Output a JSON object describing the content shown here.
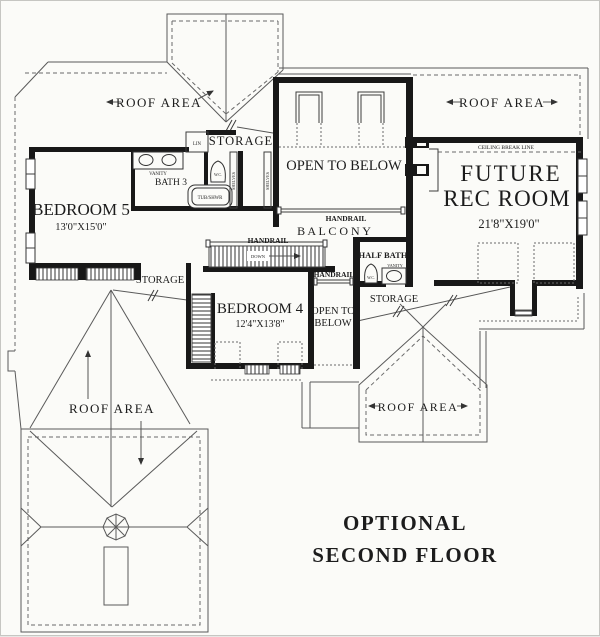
{
  "colors": {
    "background": "#fbfbf8",
    "line": "#1c1c1c",
    "roof_line": "#5a5a5a"
  },
  "title": {
    "line1": "OPTIONAL",
    "line2": "SECOND FLOOR"
  },
  "labels": {
    "roof_area": "ROOF AREA",
    "storage": "STORAGE",
    "open_to_below": "OPEN TO BELOW",
    "open_to": "OPEN TO",
    "below": "BELOW",
    "balcony": "B A L C O N Y",
    "handrail": "HANDRAIL",
    "ceiling_break_line": "CEILING BREAK LINE",
    "down": "DOWN",
    "lin": "LIN",
    "vanity": "VANITY",
    "wc": "W.C.",
    "tub_shwr": "TUB/SHWR",
    "shelves": "SHELVES",
    "half_bath": "HALF BATH",
    "bath3": "BATH 3"
  },
  "rooms": {
    "bedroom5": {
      "name": "BEDROOM 5",
      "dims": "13'0\"X15'0\""
    },
    "bedroom4": {
      "name": "BEDROOM 4",
      "dims": "12'4\"X13'8\""
    },
    "rec_room": {
      "line1": "FUTURE",
      "line2": "REC ROOM",
      "dims": "21'8\"X19'0\""
    }
  }
}
